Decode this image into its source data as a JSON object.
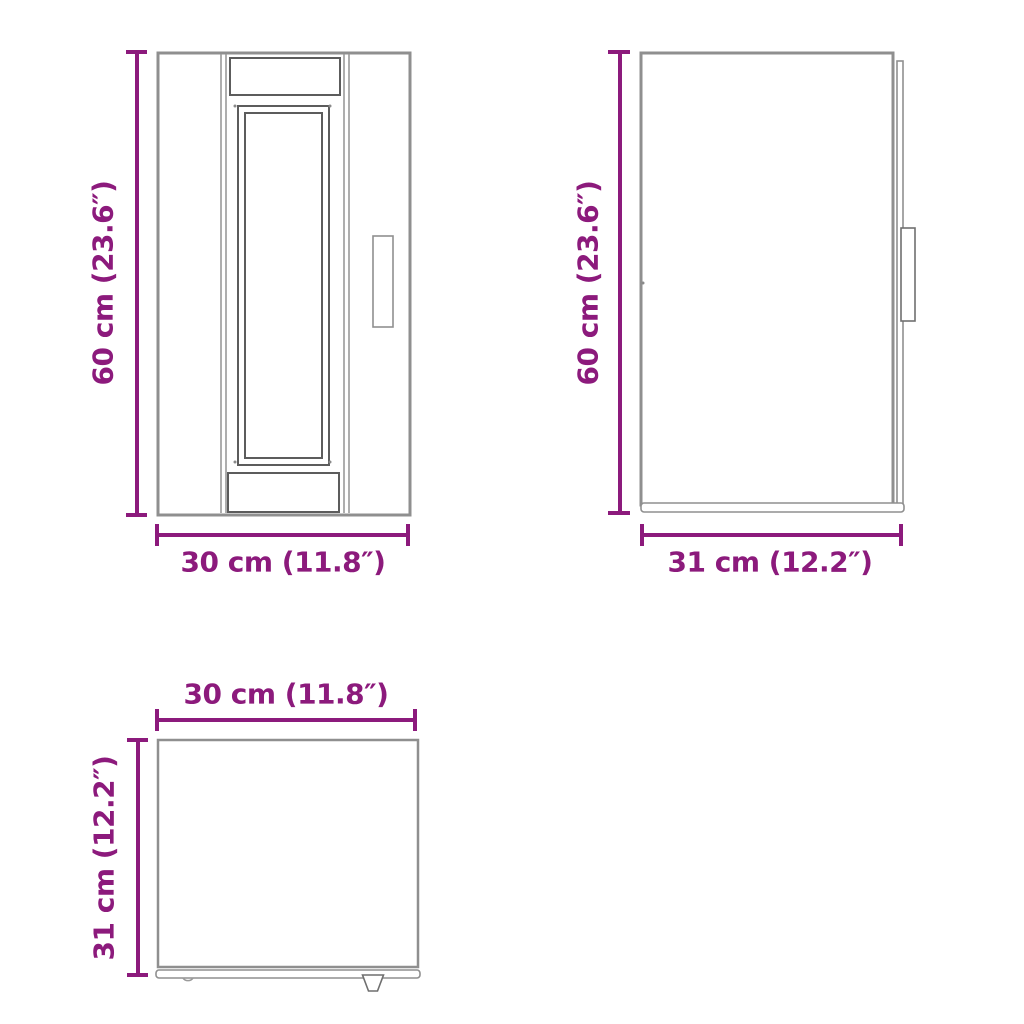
{
  "page": {
    "background": "#ffffff"
  },
  "colors": {
    "dimension_accent": "#8c1a7c",
    "outline_light": "#8f8f8f",
    "outline_dark": "#5c5c5c"
  },
  "views": {
    "front": {
      "height_label": "60 cm (23.6″)",
      "width_label": "30 cm (11.8″)"
    },
    "side": {
      "height_label": "60 cm (23.6″)",
      "depth_label": "31 cm (12.2″)"
    },
    "top": {
      "width_label": "30 cm (11.8″)",
      "depth_label": "31 cm (12.2″)"
    }
  }
}
